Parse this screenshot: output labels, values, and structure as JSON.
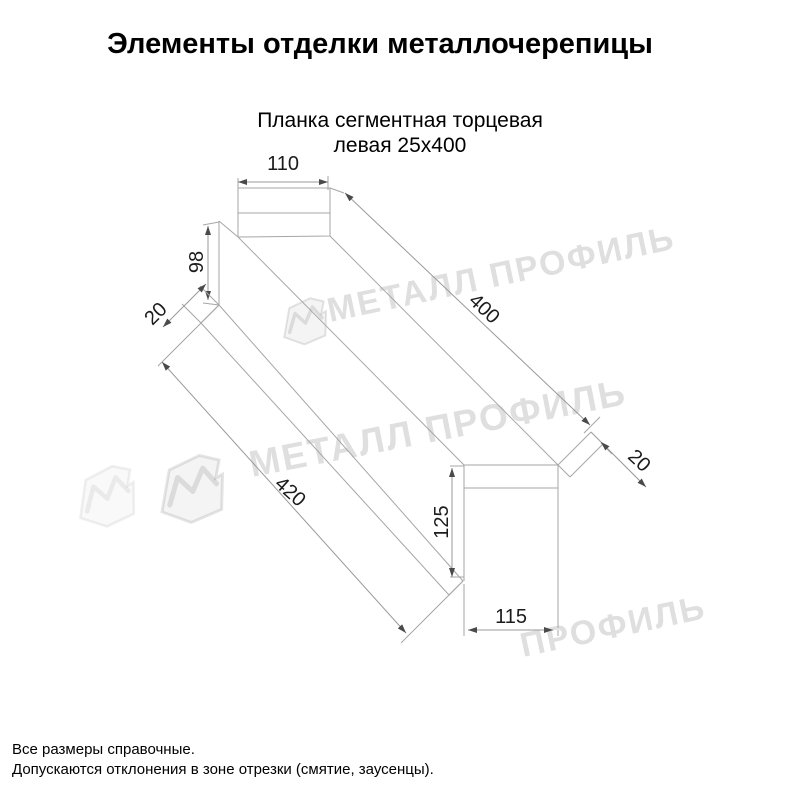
{
  "header": {
    "title": "Элементы отделки металлочерепицы",
    "subtitle_line1": "Планка сегментная торцевая",
    "subtitle_line2": "левая 25х400"
  },
  "drawing": {
    "dims": {
      "top_width": "110",
      "left_height": "98",
      "left_fold": "20",
      "length_top": "400",
      "length_bottom": "420",
      "right_fold": "20",
      "end_height": "125",
      "end_width": "115"
    }
  },
  "watermark": {
    "text": "МЕТАЛЛ ПРОФИЛЬ",
    "partial_text": "ПРОФИЛЬ"
  },
  "footer": {
    "line1": "Все размеры справочные.",
    "line2": "Допускаются отклонения в зоне отрезки (смятие, заусенцы)."
  },
  "colors": {
    "line": "#a6a6a6",
    "dim_text": "#1c1c1c",
    "text": "#000000",
    "watermark": "#c9c9c9",
    "background": "#ffffff"
  }
}
